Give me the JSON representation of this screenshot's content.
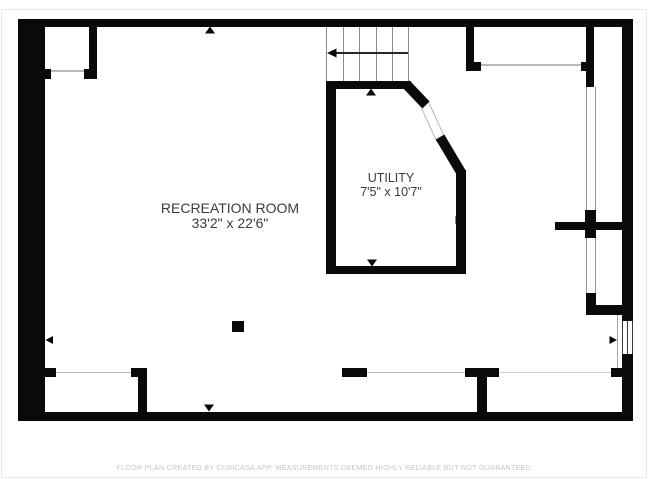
{
  "plan": {
    "rooms": [
      {
        "name": "RECREATION ROOM",
        "dimensions": "33'2\" x 22'6\""
      },
      {
        "name": "UTILITY",
        "dimensions": "7'5\" x 10'7\""
      }
    ],
    "stairs": {
      "treads": 5,
      "direction_arrow": "left"
    },
    "features": [
      "stairs",
      "window-right-wall",
      "wide-opening-top-right",
      "support-post"
    ],
    "footer": "FLOOR PLAN CREATED BY CUBICASA APP. MEASUREMENTS DEEMED HIGHLY RELIABLE BUT NOT GUARANTEED."
  },
  "colors": {
    "wall": "#0a0a0a",
    "label_text": "#3b3b3b",
    "footer_text": "#c6c6c6",
    "opening_line": "#b8b8b8",
    "stair_tread": "#8a8a8a"
  }
}
